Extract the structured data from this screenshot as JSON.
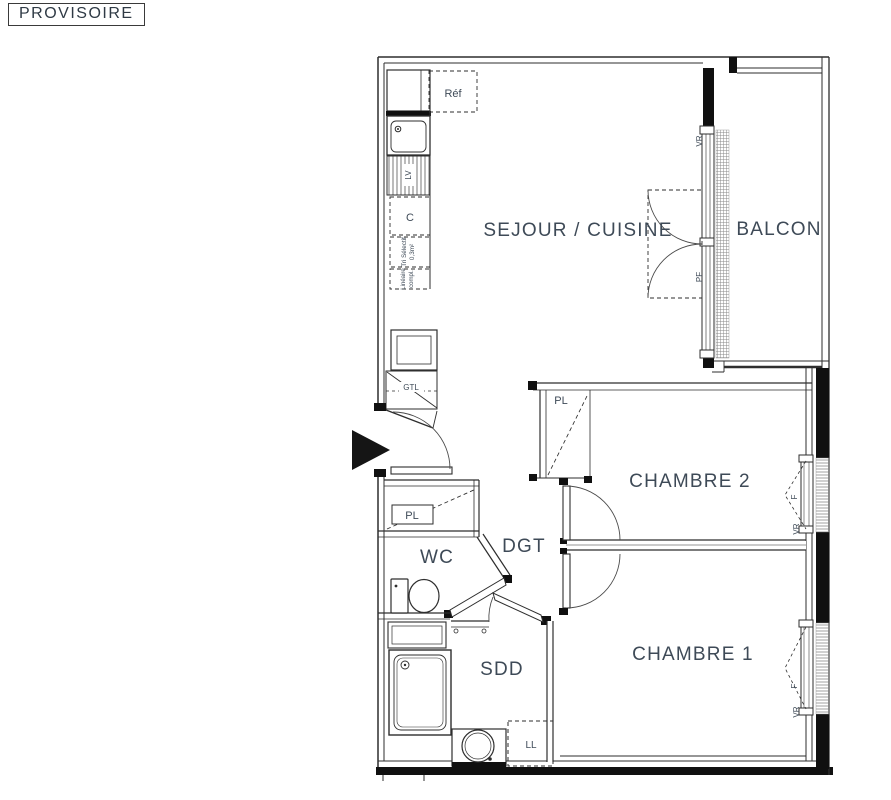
{
  "stamp": {
    "label": "PROVISOIRE"
  },
  "palette": {
    "line": "#2e2e2e",
    "wall_fill": "#101010",
    "label_color": "#3e4a57",
    "background": "#ffffff"
  },
  "rooms": {
    "sejour_cuisine": "SEJOUR / CUISINE",
    "balcon": "BALCON",
    "chambre2": "CHAMBRE 2",
    "chambre1": "CHAMBRE 1",
    "wc": "WC",
    "dgt": "DGT",
    "sdd": "SDD"
  },
  "fixtures": {
    "refrigerator": "Réf",
    "dishwasher": "LV",
    "cooker": "C",
    "waste_sorting_line1": "Tri Sélectif",
    "waste_sorting_line2": "0,3m²",
    "linear_line1": "Linéaire",
    "linear_line2": "compl.",
    "technical_duct": "GTL",
    "closet": "PL",
    "washing_machine": "LL"
  },
  "openings": {
    "roller_shutter": "VR",
    "french_window": "PF",
    "window": "F"
  }
}
